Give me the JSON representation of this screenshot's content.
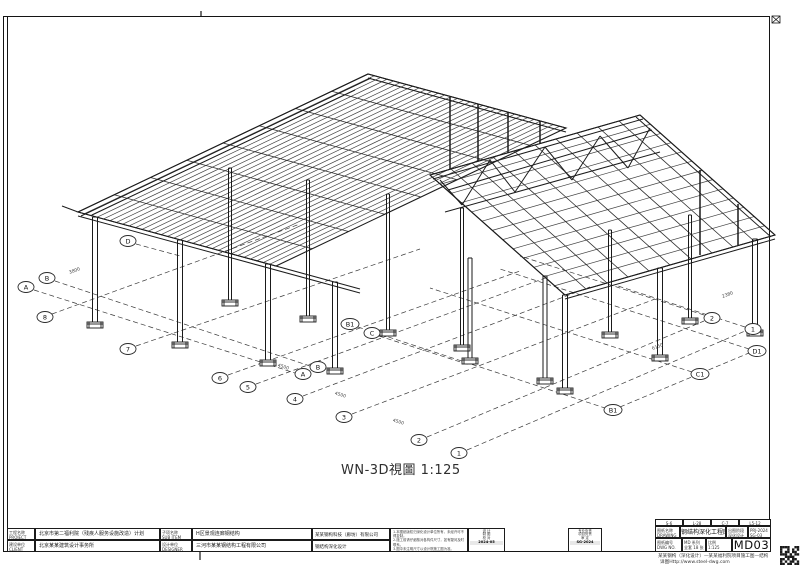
{
  "caption": "WN-3D視圖 1:125",
  "title_block": {
    "project_label": [
      "工程名称",
      "PROJECT"
    ],
    "project_value": "北京市第二福利院（残疾人服务设施改造）计划",
    "subitem_label": [
      "子项名称",
      "SUB ITEM"
    ],
    "subitem_value": "H区景观连廊钢结构",
    "client_label": [
      "建设单位",
      "CLIENT"
    ],
    "client_value": "北京某某建筑设计事务所",
    "designer_label": [
      "设计单位",
      "DESIGNER"
    ],
    "designer_value": "三河市某某钢结构工程有限公司",
    "deepen_company": "某某钢构科技（廊坊）有限公司",
    "deepen_scope": "钢结构深化设计",
    "notes": [
      "1.本图纸版权归深化设计单位所有，未经许可不得复制。",
      "2.施工前请仔细核对各构件尺寸，如有疑问及时联系。",
      "3.图中未注明尺寸以设计院施工图为准。"
    ],
    "sign1": {
      "rows": [
        "设  计",
        "制  图",
        "校  对"
      ],
      "date": "2024-05"
    },
    "sign2": {
      "rows": [
        "专业负责",
        "项目负责",
        "审  定"
      ],
      "date": "SG-2024"
    }
  },
  "right_block": {
    "codes": [
      "S-6",
      "L-28",
      "C-7",
      "L5-12"
    ],
    "name_label": [
      "图纸名称",
      "DRAWING"
    ],
    "main_title": "钢结构深化工程图",
    "stage": [
      "出图阶段",
      "深化设计"
    ],
    "prj": [
      "PRJ-2024",
      "SG-03"
    ],
    "no_label": [
      "图纸编号",
      "DWG NO."
    ],
    "series": [
      "MD 系列",
      "全套 18 张"
    ],
    "scale": [
      "比例",
      "1:125"
    ],
    "sheet_no": "MD03",
    "footer1": "某某钢构（深化设计）—某某福利院项目施工图—结构",
    "footer2": "详图Http://www.steel-dwg.com",
    "qr_pattern": [
      "11110011",
      "10010101",
      "10110110",
      "11101011",
      "00111100",
      "11010110",
      "10101101",
      "11011011"
    ]
  },
  "drawing": {
    "quads": [
      {
        "corners": [
          [
            78,
            212
          ],
          [
            368,
            74
          ],
          [
            566,
            128
          ],
          [
            276,
            266
          ]
        ],
        "nu": 7,
        "nv": 30
      },
      {
        "corners": [
          [
            430,
            175
          ],
          [
            640,
            115
          ],
          [
            775,
            235
          ],
          [
            565,
            295
          ]
        ],
        "nu": 9,
        "nv": 12
      }
    ],
    "lines": [
      [
        78,
        212,
        368,
        74
      ],
      [
        81,
        216,
        371,
        78
      ],
      [
        368,
        74,
        566,
        128
      ],
      [
        368,
        78,
        566,
        132
      ],
      [
        78,
        212,
        360,
        289
      ],
      [
        78,
        216,
        360,
        293
      ],
      [
        430,
        175,
        640,
        115
      ],
      [
        433,
        179,
        643,
        119
      ],
      [
        640,
        115,
        775,
        235
      ],
      [
        636,
        117,
        771,
        237
      ],
      [
        565,
        295,
        775,
        235
      ],
      [
        565,
        299,
        775,
        239
      ],
      [
        430,
        175,
        565,
        295
      ],
      [
        445,
        212,
        660,
        152
      ],
      [
        440,
        180,
        462,
        205
      ],
      [
        462,
        205,
        490,
        160
      ],
      [
        490,
        160,
        515,
        192
      ],
      [
        515,
        192,
        545,
        147
      ],
      [
        545,
        147,
        572,
        180
      ],
      [
        572,
        180,
        600,
        136
      ],
      [
        600,
        136,
        628,
        168
      ],
      [
        628,
        168,
        650,
        128
      ],
      [
        62,
        206,
        78,
        212
      ],
      [
        92,
        215,
        355,
        90
      ],
      [
        448,
        190,
        652,
        130
      ]
    ],
    "posts": [
      [
        450,
        97,
        169
      ],
      [
        478,
        104,
        161
      ],
      [
        508,
        112,
        153
      ],
      [
        540,
        121,
        144
      ],
      [
        700,
        170,
        255
      ],
      [
        738,
        204,
        245
      ]
    ],
    "columns": [
      [
        95,
        217,
        322,
        5
      ],
      [
        180,
        240,
        342,
        5
      ],
      [
        268,
        264,
        360,
        5
      ],
      [
        335,
        282,
        368,
        5
      ],
      [
        230,
        168,
        300,
        3
      ],
      [
        308,
        180,
        316,
        3
      ],
      [
        388,
        194,
        330,
        3
      ],
      [
        462,
        208,
        345,
        3
      ],
      [
        565,
        295,
        388,
        5
      ],
      [
        660,
        268,
        355,
        5
      ],
      [
        755,
        239,
        330,
        5
      ],
      [
        470,
        258,
        358,
        4
      ],
      [
        545,
        276,
        378,
        4
      ],
      [
        610,
        230,
        332,
        3
      ],
      [
        690,
        215,
        318,
        3
      ]
    ],
    "dashed": [
      [
        52,
        314,
        300,
        224
      ],
      [
        136,
        346,
        420,
        249
      ],
      [
        228,
        375,
        520,
        271
      ],
      [
        256,
        384,
        548,
        277
      ],
      [
        303,
        396,
        590,
        287
      ],
      [
        352,
        414,
        655,
        299
      ],
      [
        427,
        437,
        704,
        321
      ],
      [
        467,
        450,
        745,
        331
      ],
      [
        34,
        290,
        295,
        373
      ],
      [
        55,
        281,
        310,
        366
      ],
      [
        358,
        327,
        605,
        408
      ],
      [
        692,
        372,
        430,
        288
      ],
      [
        749,
        349,
        500,
        269
      ],
      [
        620,
        407,
        749,
        353
      ],
      [
        704,
        315,
        520,
        256
      ],
      [
        745,
        327,
        618,
        286
      ],
      [
        136,
        244,
        180,
        256
      ],
      [
        379,
        336,
        470,
        365
      ]
    ],
    "bubbles": [
      {
        "label": "A",
        "x": 26,
        "y": 287
      },
      {
        "label": "B",
        "x": 47,
        "y": 278
      },
      {
        "label": "8",
        "x": 45,
        "y": 317
      },
      {
        "label": "D",
        "x": 128,
        "y": 241
      },
      {
        "label": "7",
        "x": 128,
        "y": 349
      },
      {
        "label": "6",
        "x": 220,
        "y": 378
      },
      {
        "label": "5",
        "x": 248,
        "y": 387
      },
      {
        "label": "A",
        "x": 303,
        "y": 374
      },
      {
        "label": "B",
        "x": 318,
        "y": 367
      },
      {
        "label": "4",
        "x": 295,
        "y": 399
      },
      {
        "label": "3",
        "x": 344,
        "y": 417
      },
      {
        "label": "2",
        "x": 419,
        "y": 440
      },
      {
        "label": "1",
        "x": 459,
        "y": 453
      },
      {
        "label": "B1",
        "x": 350,
        "y": 324
      },
      {
        "label": "C",
        "x": 372,
        "y": 333
      },
      {
        "label": "2",
        "x": 712,
        "y": 318
      },
      {
        "label": "1",
        "x": 753,
        "y": 329
      },
      {
        "label": "D1",
        "x": 757,
        "y": 351
      },
      {
        "label": "C1",
        "x": 700,
        "y": 374
      },
      {
        "label": "B1",
        "x": 613,
        "y": 410
      }
    ],
    "dims": [
      {
        "t": "4500",
        "x": 283,
        "y": 368,
        "r": 17
      },
      {
        "t": "4500",
        "x": 340,
        "y": 396,
        "r": 17
      },
      {
        "t": "4500",
        "x": 398,
        "y": 423,
        "r": 17
      },
      {
        "t": "3800",
        "x": 75,
        "y": 272,
        "r": -21
      },
      {
        "t": "6150",
        "x": 658,
        "y": 348,
        "r": -21
      },
      {
        "t": "2380",
        "x": 728,
        "y": 296,
        "r": -21
      }
    ]
  }
}
